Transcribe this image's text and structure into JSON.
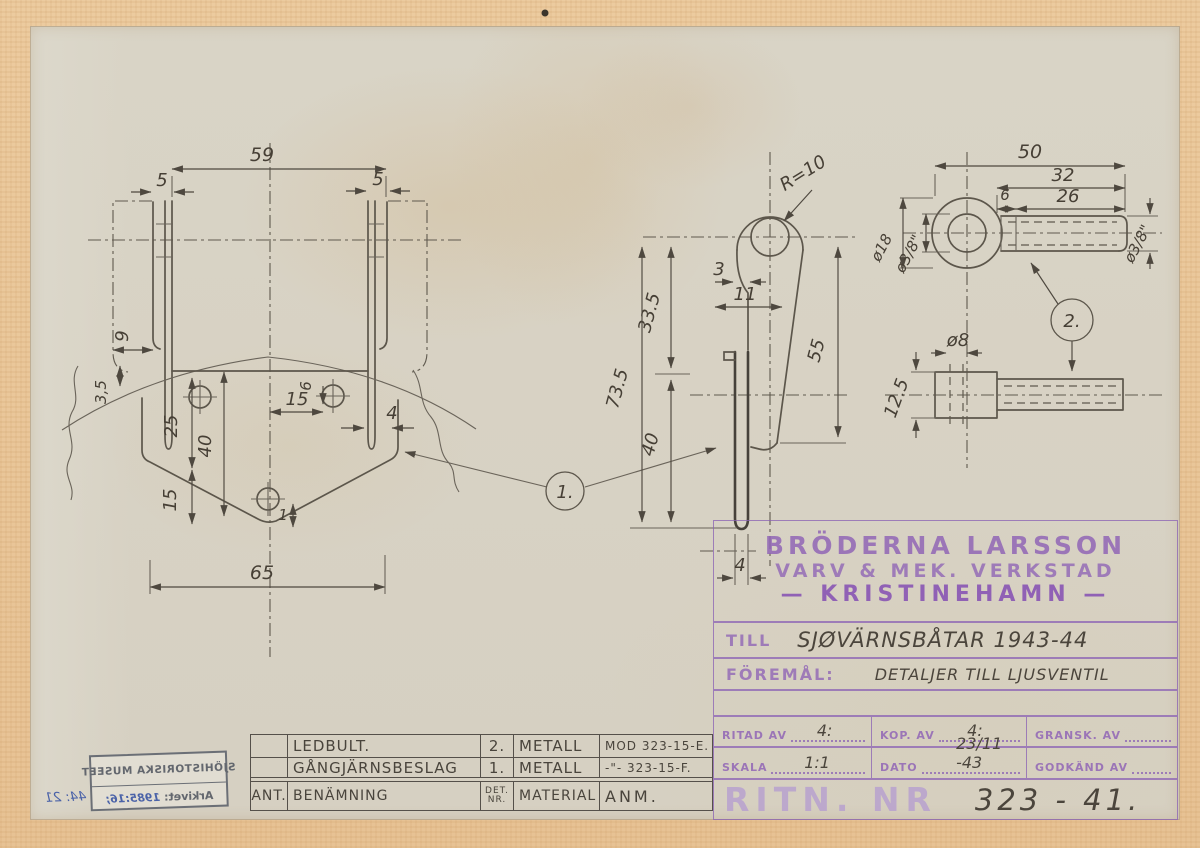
{
  "dims": {
    "left": {
      "d59": "59",
      "d5_left": "5",
      "d5_right": "5",
      "d9": "9",
      "d3_5": "3,5",
      "d25": "25",
      "d40": "40",
      "d15_vert": "15",
      "d15_horiz": "15",
      "d6": "6",
      "d4_slot": "4",
      "d1": "1",
      "d65": "65"
    },
    "middle": {
      "r10": "R=10",
      "d3": "3",
      "d11": "11",
      "d33_5": "33.5",
      "d73_5": "73.5",
      "d40": "40",
      "d55": "55",
      "d4": "4"
    },
    "right_top": {
      "d50": "50",
      "d32": "32",
      "d26": "26",
      "d6": "6",
      "dia18": "ø18",
      "dia38_left": "ø3/8\"",
      "dia38_right": "ø3/8\""
    },
    "right_side": {
      "dia8": "ø8",
      "d12_5": "12.5"
    },
    "detail1": "1.",
    "detail2": "2."
  },
  "title_block": {
    "company_line1": "BRÖDERNA LARSSON",
    "company_line2": "VARV & MEK. VERKSTAD",
    "company_line3": "—  KRISTINEHAMN  —",
    "till_label": "TILL",
    "till_value": "SJØVÄRNSBÅTAR 1943-44",
    "foremal_label": "FÖREMÅL:",
    "foremal_value": "DETALJER TILL LJUSVENTIL",
    "ritad_av_label": "RITAD AV",
    "ritad_av_value": "4:",
    "kop_av_label": "KOP. AV",
    "kop_av_value": "4:",
    "gransk_av_label": "GRANSK. AV",
    "gransk_av_value": "",
    "skala_label": "SKALA",
    "skala_value": "1:1",
    "dato_label": "DATO",
    "dato_value": "23/11 -43",
    "godkand_av_label": "GODKÄND AV",
    "godkand_av_value": "",
    "ritn_nr_label": "RITN. NR",
    "ritn_nr_value": "323 - 41."
  },
  "parts_table": {
    "rows": [
      {
        "ant": "",
        "benamning": "LEDBULT.",
        "det_nr": "2.",
        "material": "METALL",
        "anm": "MOD 323-15-E."
      },
      {
        "ant": "",
        "benamning": "GÅNGJÄRNSBESLAG",
        "det_nr": "1.",
        "material": "METALL",
        "anm": "-\"- 323-15-F."
      }
    ],
    "headers": {
      "ant": "ANT.",
      "benamning": "BENÄMNING",
      "det_nr": "DET.\nNR.",
      "material": "MATERIAL",
      "anm": "ANM."
    }
  },
  "stamp": {
    "museum": "SJÖHISTORISKA MUSEET",
    "arkivet_label": "Arkivet:",
    "arkivet_value": "1985:16;",
    "handwritten": "44: 21"
  }
}
